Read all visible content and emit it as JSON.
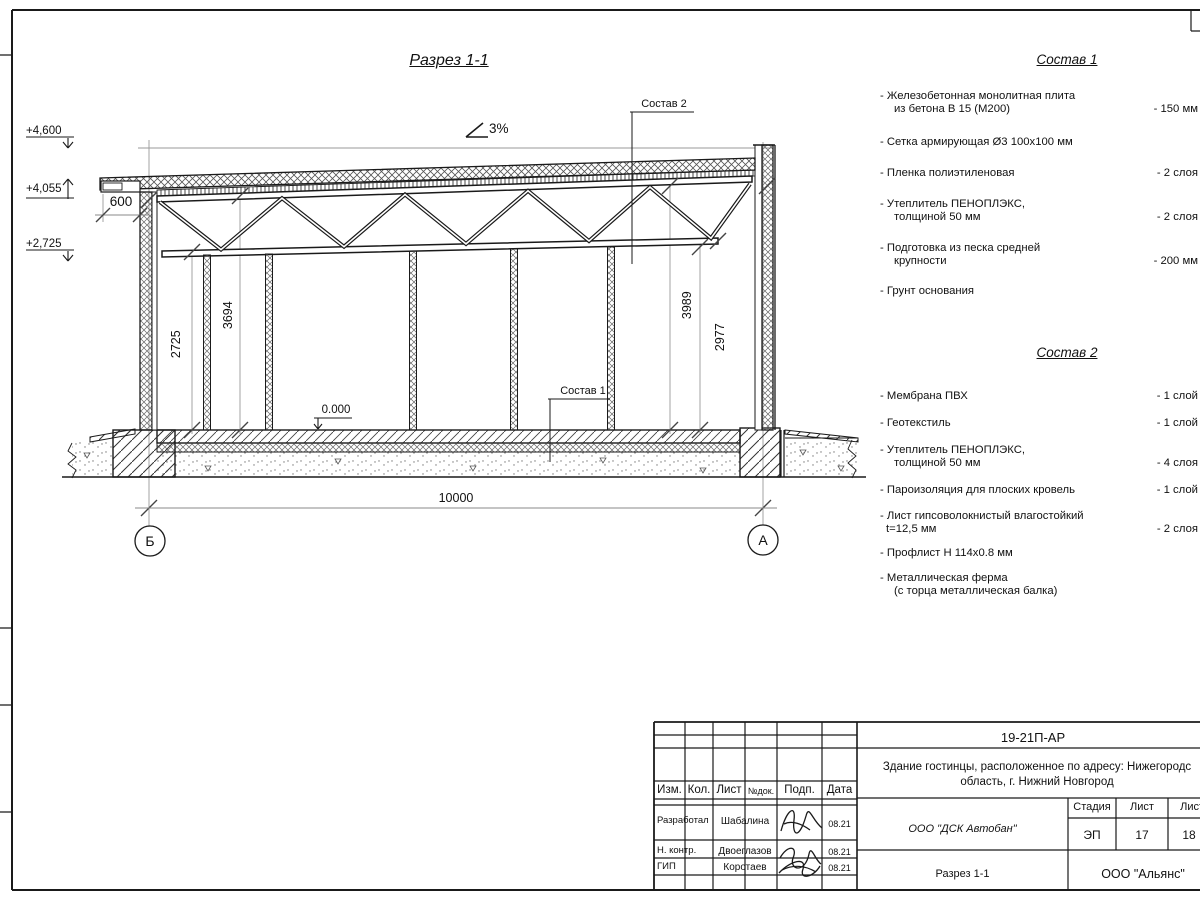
{
  "drawing": {
    "title": "Разрез 1-1",
    "slope_label": "3%",
    "elevations": {
      "top": "+4,600",
      "eaves": "+4,055",
      "chord": "+2,725"
    },
    "overhang_dim": "600",
    "dims": {
      "left_chord": "2725",
      "left_top": "3694",
      "right_top": "3989",
      "right_chord": "2977",
      "span": "10000"
    },
    "level_mark": "0.000",
    "callout_1": "Состав 1",
    "callout_2": "Состав 2",
    "axis_left": "Б",
    "axis_right": "А"
  },
  "sostav1": {
    "title": "Состав 1",
    "items": [
      {
        "line1": "- Железобетонная  монолитная плита",
        "line2": "из бетона В 15 (М200)",
        "value": "- 150 мм"
      },
      {
        "line1": "- Сетка армирующая Ø3 100х100 мм",
        "line2": "",
        "value": ""
      },
      {
        "line1": "- Пленка полиэтиленовая",
        "line2": "",
        "value": "- 2 слоя"
      },
      {
        "line1": "- Утеплитель ПЕНОПЛЭКС,",
        "line2": "толщиной 50 мм",
        "value": "- 2 слоя"
      },
      {
        "line1": "- Подготовка из песка средней",
        "line2": "крупности",
        "value": "- 200 мм"
      },
      {
        "line1": "- Грунт основания",
        "line2": "",
        "value": ""
      }
    ]
  },
  "sostav2": {
    "title": "Состав 2",
    "items": [
      {
        "line1": "- Мембрана ПВХ",
        "line2": "",
        "value": "- 1 слой"
      },
      {
        "line1": "- Геотекстиль",
        "line2": "",
        "value": "- 1 слой"
      },
      {
        "line1": "- Утеплитель ПЕНОПЛЭКС,",
        "line2": "толщиной 50 мм",
        "value": "- 4 слоя"
      },
      {
        "line1": "- Пароизоляция для плоских кровель",
        "line2": "",
        "value": "- 1 слой"
      },
      {
        "line1": "- Лист гипсоволокнистый влагостойкий",
        "line2": "t=12,5 мм",
        "value": "- 2 слоя"
      },
      {
        "line1": "- Профлист Н 114х0.8 мм",
        "line2": "",
        "value": ""
      },
      {
        "line1": "- Металлическая ферма",
        "line2": "(с торца металлическая балка)",
        "value": ""
      }
    ]
  },
  "title_block": {
    "doc_code": "19-21П-АР",
    "project_line1": "Здание гостинцы, расположенное по адресу: Нижегородс",
    "project_line2": "область, г. Нижний Новгород",
    "col_izm": "Изм.",
    "col_kol": "Кол.",
    "col_list": "Лист",
    "col_ndoc": "№док.",
    "col_podp": "Подп.",
    "col_data": "Дата",
    "row1_role": "Разработал",
    "row1_name": "Шабалина",
    "row1_date": "08.21",
    "row2_role": "Н. контр.",
    "row2_name": "Двоеглазов",
    "row2_date": "08.21",
    "row3_role": "ГИП",
    "row3_name": "Коротаев",
    "row3_date": "08.21",
    "organization": "ООО \"ДСК Автобан\"",
    "stage_label": "Стадия",
    "sheet_label": "Лист",
    "sheets_label": "Листов",
    "stage": "ЭП",
    "sheet": "17",
    "sheets": "18",
    "drawing_name": "Разрез 1-1",
    "company": "ООО \"Альянс\""
  },
  "colors": {
    "line": "#1a1a1a",
    "thin": "#909090",
    "hatch": "#555555"
  }
}
